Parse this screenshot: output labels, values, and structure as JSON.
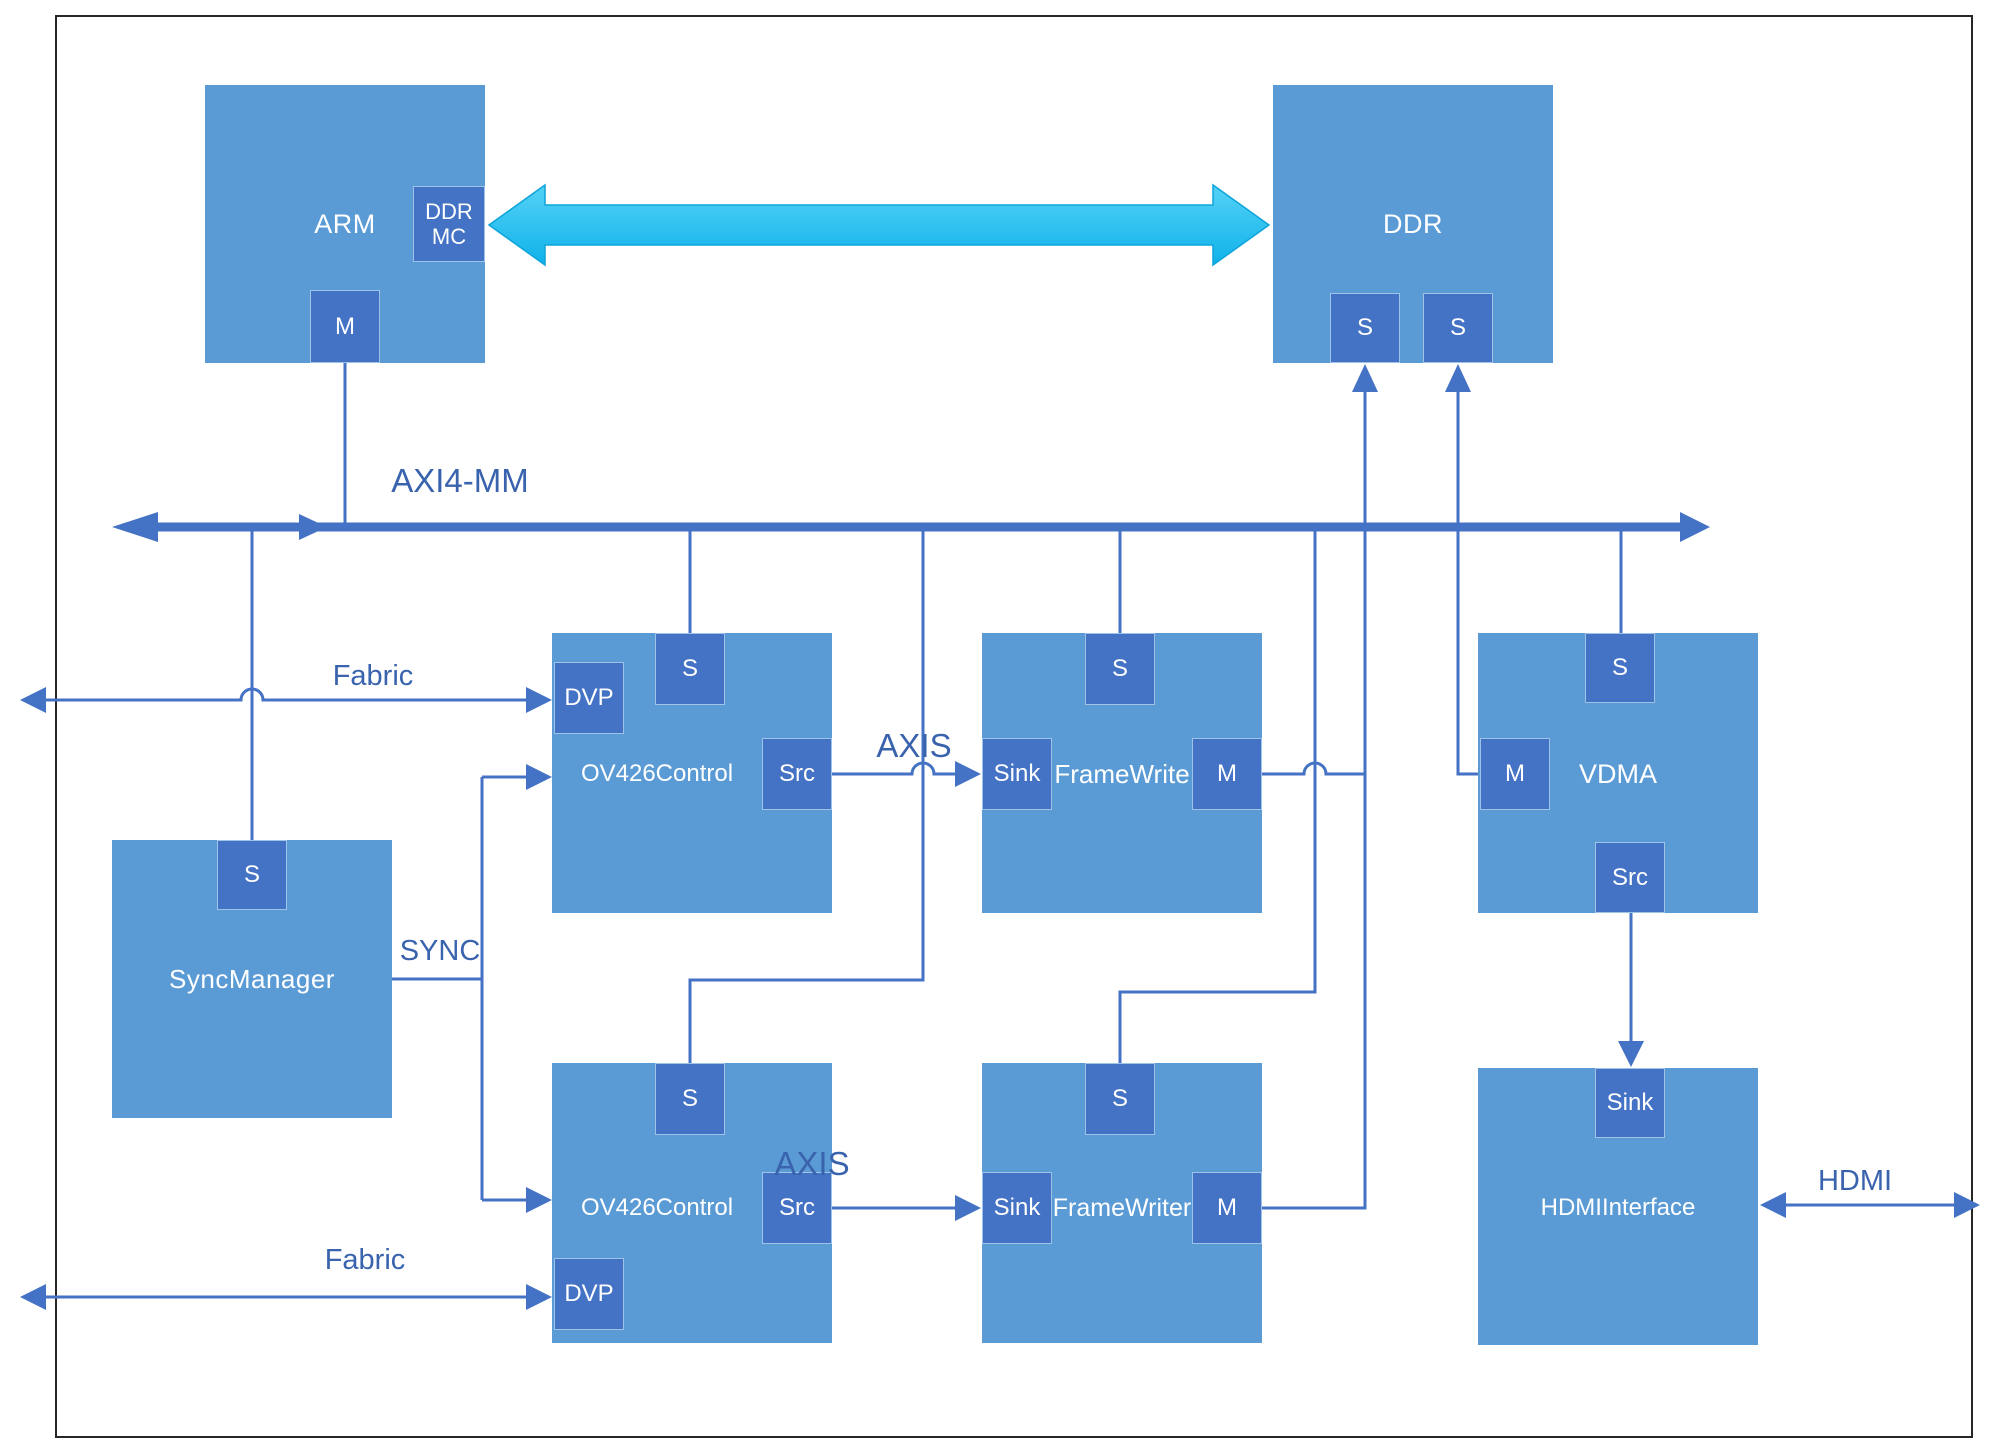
{
  "labels": {
    "bus": "AXI4-MM",
    "fabric_top": "Fabric",
    "fabric_bottom": "Fabric",
    "sync": "SYNC",
    "axis_top": "AXIS",
    "axis_bottom": "AXIS",
    "hdmi": "HDMI"
  },
  "blocks": {
    "arm": {
      "label": "ARM",
      "port_ddr_mc": "DDR MC",
      "port_m": "M"
    },
    "ddr": {
      "label": "DDR",
      "port_s1": "S",
      "port_s2": "S"
    },
    "sync_manager": {
      "label": "SyncManager",
      "port_s": "S"
    },
    "ov426_top": {
      "label": "OV426Control",
      "port_s": "S",
      "port_dvp": "DVP",
      "port_src": "Src"
    },
    "framewrite_top": {
      "label": "FrameWrite",
      "port_s": "S",
      "port_sink": "Sink",
      "port_m": "M"
    },
    "vdma": {
      "label": "VDMA",
      "port_s": "S",
      "port_m": "M",
      "port_src": "Src"
    },
    "ov426_bottom": {
      "label": "OV426Control",
      "port_s": "S",
      "port_dvp": "DVP",
      "port_src": "Src"
    },
    "framewriter_bottom": {
      "label": "FrameWriter",
      "port_s": "S",
      "port_sink": "Sink",
      "port_m": "M"
    },
    "hdmi_interface": {
      "label": "HDMIInterface",
      "port_sink": "Sink"
    }
  },
  "colors": {
    "block_fill": "#5b9bd5",
    "port_fill": "#4472c4",
    "connector": "#4472c4",
    "memory_arrow": "#29c2f0",
    "label_text": "#3a63ae",
    "frame_border": "#262626"
  }
}
